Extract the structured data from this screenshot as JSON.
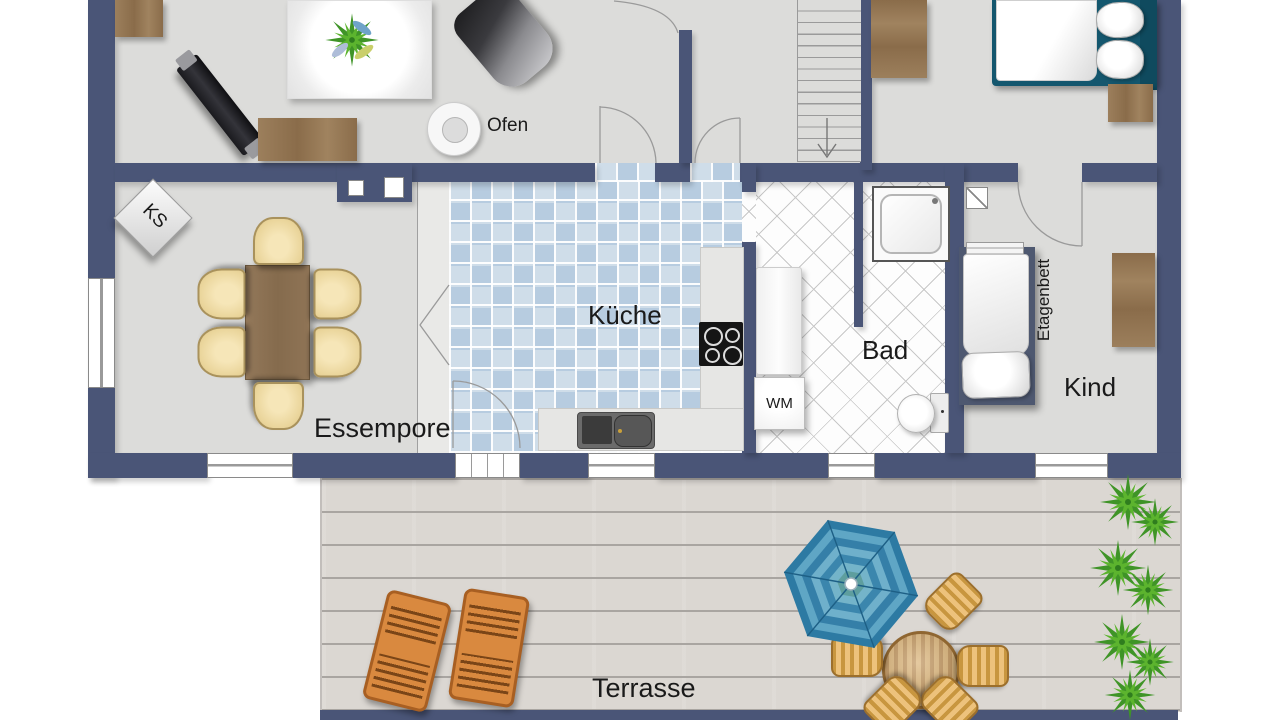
{
  "title": "Wohnung Grundriss",
  "rooms": {
    "kueche": "Küche",
    "bad": "Bad",
    "kind": "Kind",
    "essempore": "Essempore",
    "terrasse": "Terrasse"
  },
  "labels": {
    "ofen": "Ofen",
    "wm": "WM",
    "ks": "KS",
    "etagenbett": "Etagenbett"
  },
  "colors": {
    "wall": "#4a5577",
    "floor": "#dcdcda",
    "kitchen_tile_a": "#b7cce0",
    "kitchen_tile_b": "#cfdde9",
    "bath_tile": "#fdfdfd",
    "terrace_deck": "#dbd7d2",
    "umbrella_blue": "#2e7ea6",
    "plant_green": "#3f9427",
    "wood_brown": "#97795a",
    "chair_cream": "#f1dfae",
    "lounger_orange": "#d9893f",
    "bed_teal": "#14576e"
  }
}
